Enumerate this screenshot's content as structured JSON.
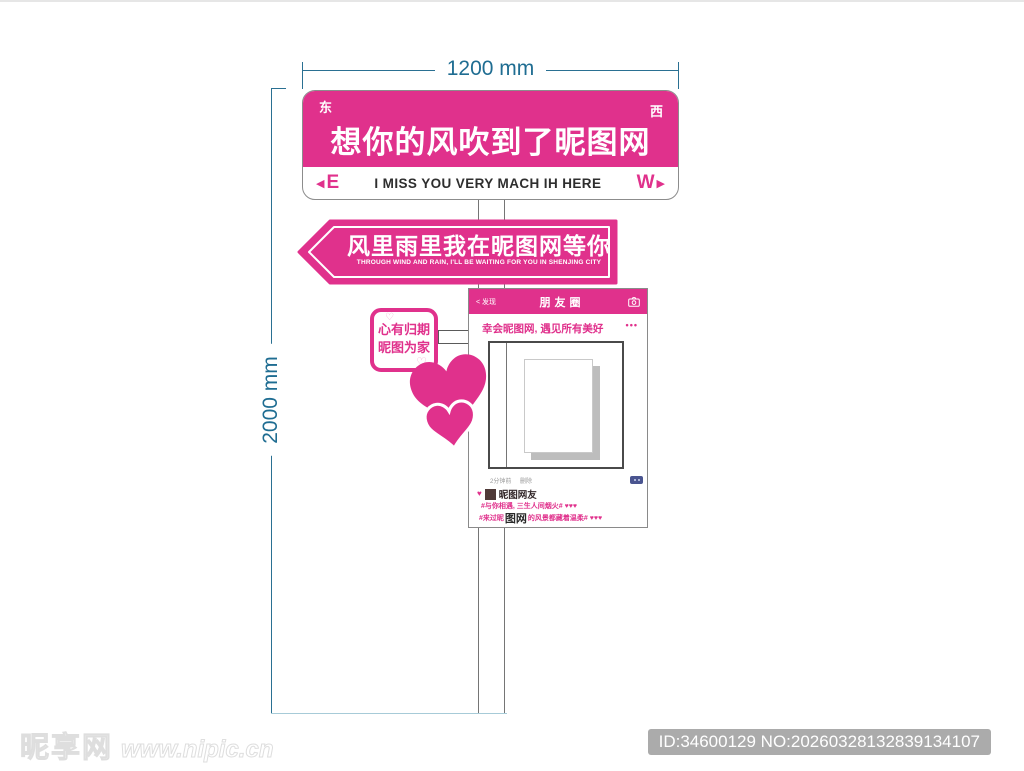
{
  "colors": {
    "pink": "#E0318C",
    "teal": "#1F6D92",
    "ground_line": "#A7CBD8"
  },
  "dimensions": {
    "width_label": "1200 mm",
    "height_label": "2000 mm"
  },
  "top_sign": {
    "corner_east": "东",
    "corner_west": "西",
    "title": "想你的风吹到了昵图网",
    "band_left_arrow": "◀",
    "band_left_letter": "E",
    "band_text": "I MISS YOU VERY MACH IH HERE",
    "band_right_letter": "W",
    "band_right_arrow": "▶"
  },
  "arrow_sign": {
    "title": "风里雨里我在昵图网等你",
    "subtitle": "THROUGH WIND AND RAIN, I'LL BE WAITING FOR YOU IN SHENJING CITY"
  },
  "square_sign": {
    "heart_outline_top": "♡",
    "line1": "心有归期",
    "line2": "昵图为家",
    "heart_outline_bottom": "♡"
  },
  "moments_card": {
    "back_label": "< 发现",
    "title": "朋友圈",
    "caption": "幸会昵图网, 遇见所有美好",
    "more_dots": "•••",
    "timestamp": "2分钟前",
    "delete_label": "删除",
    "like_heart": "♥",
    "username": "昵图网友",
    "comment1": "#与你相遇, 三生人间烟火# ♥♥♥",
    "comment2_prefix": "#来过昵",
    "comment2_bold": "图网",
    "comment2_suffix": "的风景都藏着温柔# ♥♥♥"
  },
  "footer": {
    "watermark_logo": "昵享网",
    "watermark_url": "www.nipic.cn",
    "id_text": "ID:34600129 NO:20260328132839134107"
  }
}
